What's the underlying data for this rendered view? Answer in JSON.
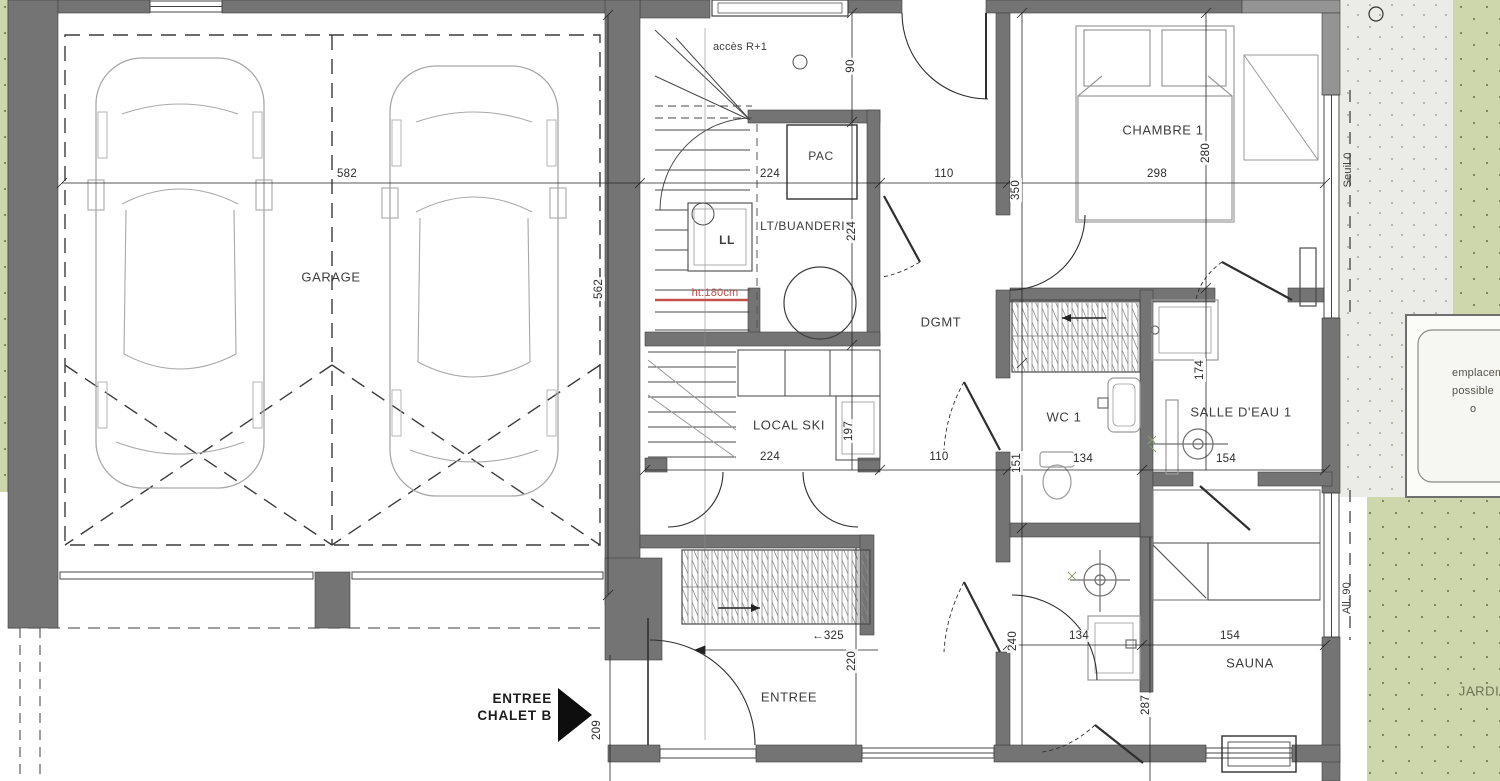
{
  "plan": {
    "rooms": {
      "garage": "GARAGE",
      "laundry": "LT/BUANDERIE",
      "hall": "DGMT",
      "bedroom": "CHAMBRE 1",
      "wc": "WC 1",
      "bath1": "SALLE D'EAU 1",
      "ski": "LOCAL SKI",
      "entry": "ENTREE",
      "sauna": "SAUNA",
      "garden": "JARDIN"
    },
    "labels": {
      "stairs_access": "accès R+1",
      "washer": "LL",
      "heat_pump": "PAC",
      "height_note": "ht:180cm",
      "threshold": "Seuil 0",
      "sill": "All. 90",
      "placement_line1": "emplacement",
      "placement_line2": "possible",
      "placement_line3": "o"
    },
    "entrance_arrow": {
      "line1": "ENTREE",
      "line2": "CHALET B"
    },
    "dims": {
      "garage_w": "582",
      "garage_d": "562",
      "top_90": "90",
      "laundry_w": "224",
      "laundry_d": "224",
      "hall_top": "110",
      "bed_w": "298",
      "bed_d": "280",
      "bed_side": "350",
      "ski_w": "224",
      "ski_d": "197",
      "hall_mid": "110",
      "wc_w": "134",
      "wc_side": "151",
      "bath1_w": "154",
      "bath1_d": "174",
      "closet_arrow": "←325",
      "entry_d": "220",
      "bath2_w": "134",
      "bath2_side": "240",
      "sauna_w": "154",
      "sauna_d": "287",
      "porch": "209"
    },
    "colors": {
      "wall": "#747474",
      "wall_light": "#949494",
      "garden": "#cdd7ab",
      "terrace": "#ebebe7",
      "annotation_red": "#c4504e",
      "arrow_black": "#0e0e0e"
    }
  }
}
